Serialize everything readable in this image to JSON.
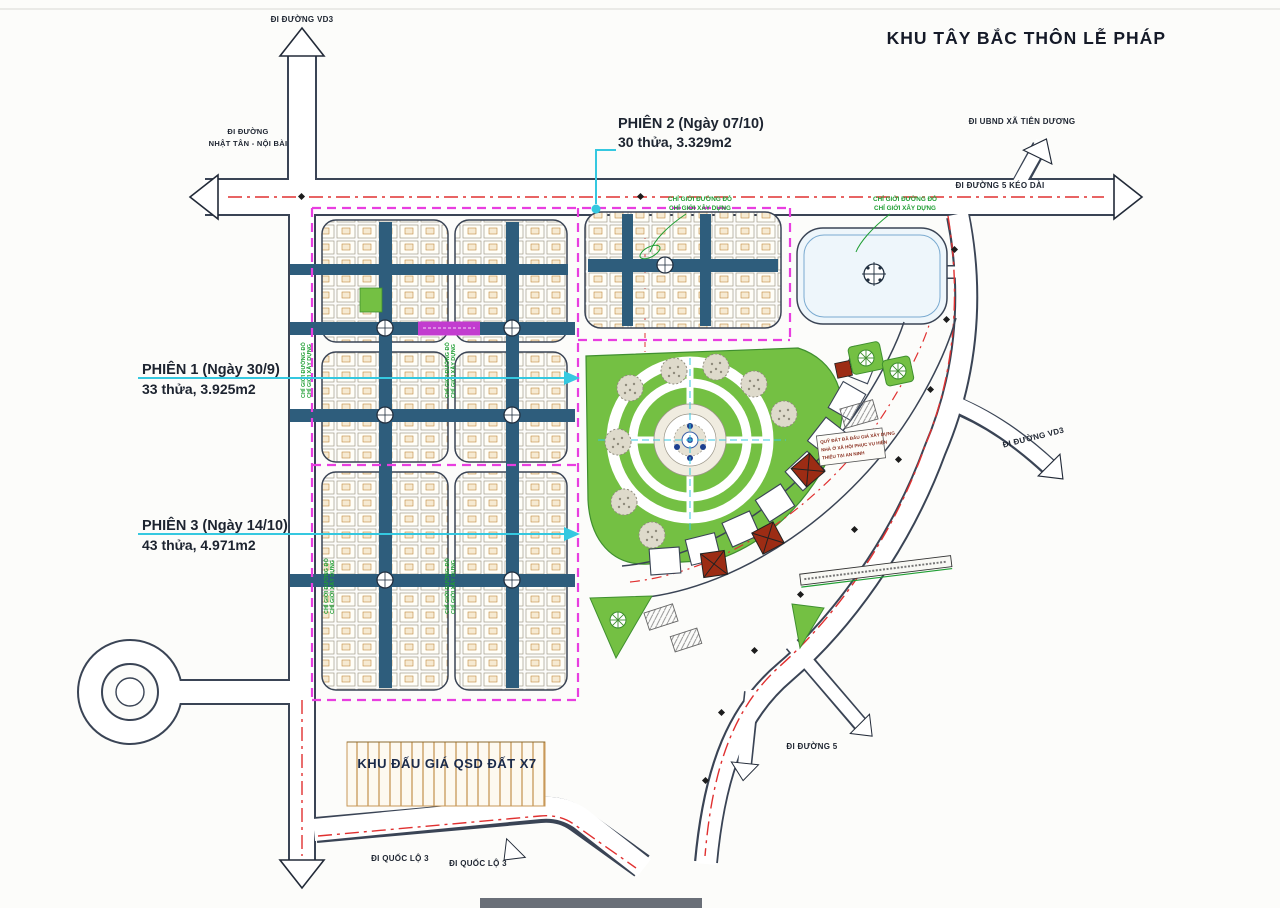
{
  "title": "KHU TÂY BẮC THÔN LỄ PHÁP",
  "sessions": [
    {
      "name": "PHIÊN 1 (Ngày 30/9)",
      "detail": "33 thửa, 3.925m2"
    },
    {
      "name": "PHIÊN 2 (Ngày 07/10)",
      "detail": "30 thửa, 3.329m2"
    },
    {
      "name": "PHIÊN 3 (Ngày 14/10)",
      "detail": "43 thửa, 4.971m2"
    }
  ],
  "roads": {
    "vd3_top": "ĐI ĐƯỜNG VD3",
    "nhat_tan_line1": "ĐI ĐƯỜNG",
    "nhat_tan_line2": "NHẬT TÂN - NỘI BÀI",
    "ubnd": "ĐI UBND XÃ TIÊN DƯƠNG",
    "duong5_keodai": "ĐI ĐƯỜNG 5 KÉO DÀI",
    "vd3_right": "ĐI ĐƯỜNG VD3",
    "duong5": "ĐI ĐƯỜNG 5",
    "quoc_lo_3_a": "ĐI QUỐC LỘ 3",
    "quoc_lo_3_b": "ĐI QUỐC LỘ 3"
  },
  "areas": {
    "auction_x7": "KHU ĐẤU GIÁ QSD ĐẤT X7"
  },
  "boundary_notes": {
    "red_line": "CHỈ GIỚI ĐƯỜNG ĐỎ",
    "construction_line": "CHỈ GIỚI XÂY DỰNG"
  },
  "small_note": {
    "line1": "QUỸ ĐẤT ĐÃ ĐẤU GIÁ XÂY DỰNG",
    "line2": "NHÀ Ở XÃ HỘI PHỤC VỤ HIỆN",
    "line3": "THIẾU TẠI AN NINH"
  },
  "colors": {
    "boundary_pink": "#e83ee0",
    "centerline_red": "#e03030",
    "leader_cyan": "#35c8e0",
    "note_green": "#1f9e33",
    "park_green": "#74c043",
    "spine_blue": "#2e5d7c",
    "building_red": "#9c2c14",
    "road_casing": "#3a4455",
    "auction_strip_tan": "#c89858"
  }
}
